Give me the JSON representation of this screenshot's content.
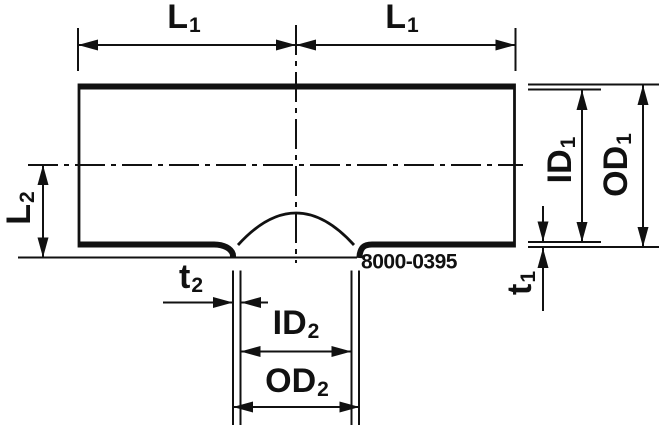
{
  "drawing": {
    "part_number": "8000-0395",
    "labels": {
      "l1_left": {
        "base": "L",
        "sub": "1"
      },
      "l1_right": {
        "base": "L",
        "sub": "1"
      },
      "l2": {
        "base": "L",
        "sub": "2"
      },
      "id1": {
        "base": "ID",
        "sub": "1"
      },
      "od1": {
        "base": "OD",
        "sub": "1"
      },
      "t1": {
        "base": "t",
        "sub": "1"
      },
      "t2": {
        "base": "t",
        "sub": "2"
      },
      "id2": {
        "base": "ID",
        "sub": "2"
      },
      "od2": {
        "base": "OD",
        "sub": "2"
      }
    },
    "colors": {
      "line": "#111111",
      "background": "#ffffff"
    }
  }
}
